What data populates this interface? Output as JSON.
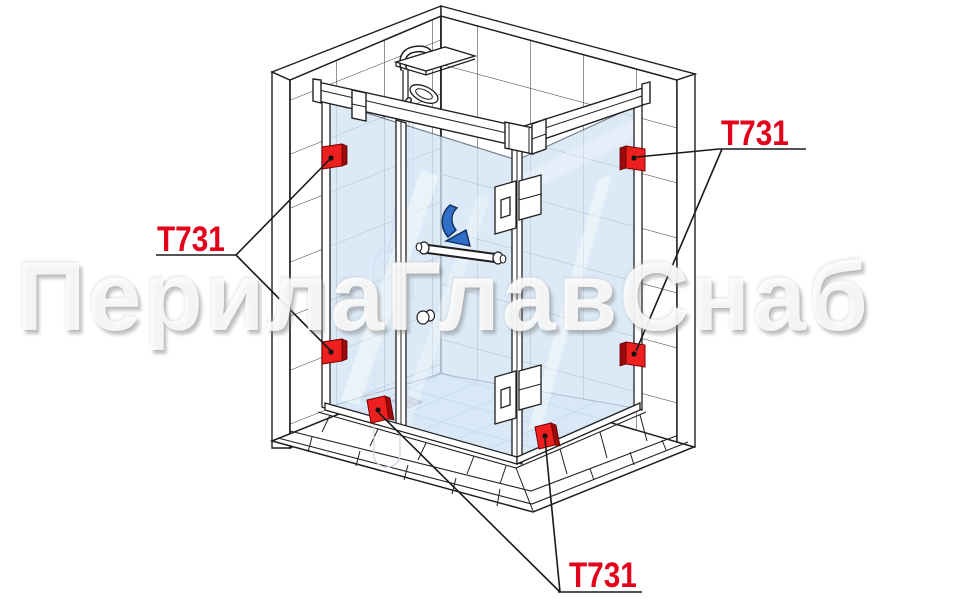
{
  "watermark": {
    "text": "ПерилаГлавСнаб"
  },
  "part_labels": [
    {
      "position": "left",
      "text": "Т731"
    },
    {
      "position": "top-right",
      "text": "Т731"
    },
    {
      "position": "bottom",
      "text": "Т731"
    }
  ],
  "connector": {
    "model": "Т731",
    "count_visible": 6
  },
  "icons": {
    "door_swing_arrow": "curved-arrow-down-right"
  },
  "colors": {
    "label_red": "#e3001b",
    "connector_red": "#ee1f1f",
    "connector_red_dark": "#9c0b0b",
    "line": "#1f1f1f",
    "glass_blue": "#d3e5f6",
    "glass_line": "#a9c4de",
    "arrow_blue": "#2f6fc8",
    "arrow_outline": "#0e2a5c",
    "watermark_shadow": "#9a9a9a"
  }
}
